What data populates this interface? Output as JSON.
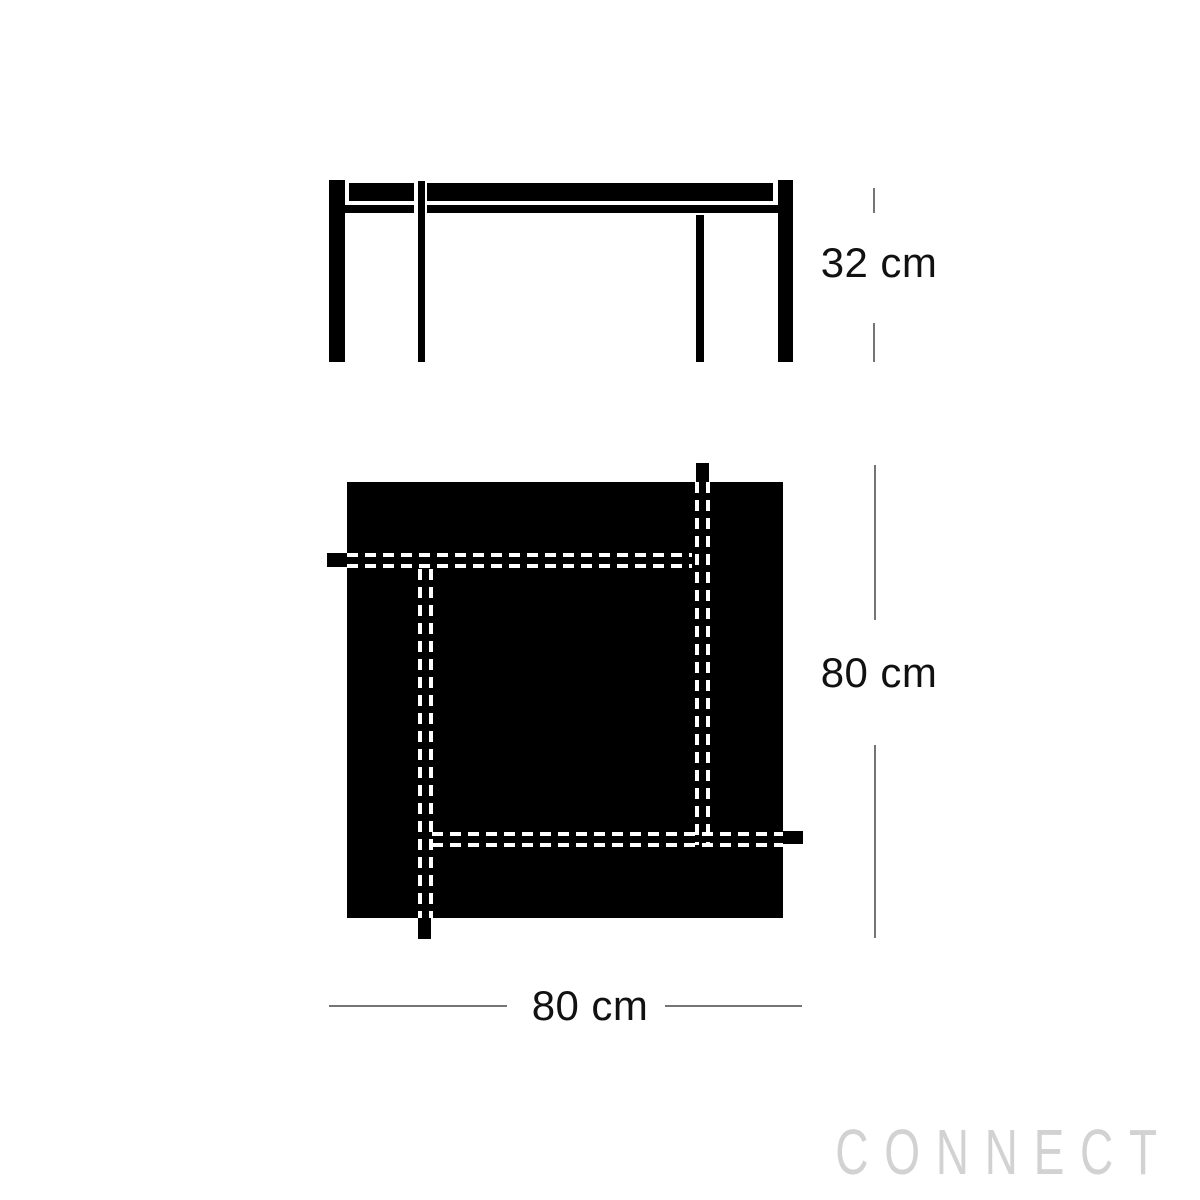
{
  "diagram": {
    "kind": "furniture dimension drawing (side elevation and plan view of a square table)",
    "side_view": {
      "height_label": "32 cm"
    },
    "plan_view": {
      "depth_label": "80 cm",
      "width_label": "80 cm"
    }
  },
  "watermark": {
    "text": "CONNECT"
  },
  "colors": {
    "background": "#ffffff",
    "drawing": "#000000",
    "hidden_line": "#ffffff",
    "dimension_line": "#757575",
    "label_text": "#111111",
    "watermark": "#d2d2d2"
  }
}
